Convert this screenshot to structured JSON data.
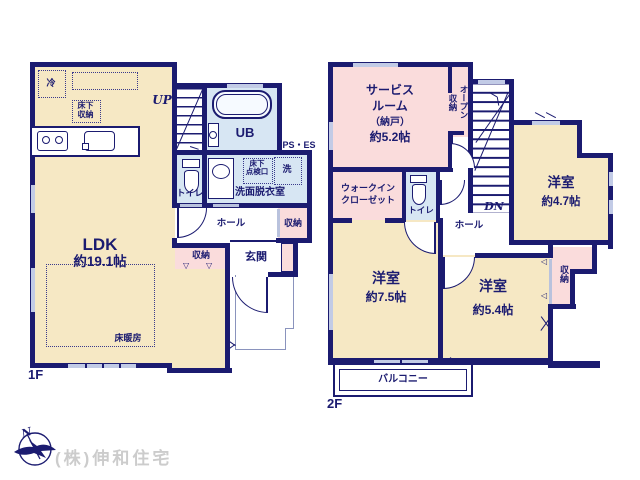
{
  "colors": {
    "wall": "#1b1b70",
    "beige": "#f6e8c4",
    "pink": "#fadcdc",
    "blue": "#d7e6f3",
    "window": "#c2cbe6",
    "porch": "#8a93bd",
    "watermark": "#cccccc",
    "fixture_fill": "#f6faff"
  },
  "symbols": {
    "tri_down": "▽",
    "tri_left": "◁"
  },
  "compass": {
    "north": "N"
  },
  "watermark": "(株)伸和住宅",
  "f1": {
    "floor": "1F",
    "ldk": {
      "name": "LDK",
      "size": "約19.1帖",
      "heating": "床暖房",
      "fridge": "冷",
      "uf1": "床下",
      "uf2": "収納",
      "closet": "収納"
    },
    "stairs": "UP",
    "bath": "UB",
    "shaft": "PS・ES",
    "toilet": "トイレ",
    "wash": {
      "name": "洗面脱衣室",
      "h1": "床下",
      "h2": "点検口",
      "washer": "洗"
    },
    "hall": {
      "name": "ホール",
      "closet": "収納"
    },
    "entrance": "玄関"
  },
  "f2": {
    "floor": "2F",
    "service": {
      "l1": "サービス",
      "l2": "ルーム",
      "l3": "（納戸）",
      "size": "約5.2帖",
      "open": "オープン収納"
    },
    "stairs": "DN",
    "r47": {
      "name": "洋室",
      "size": "約4.7帖"
    },
    "wic": {
      "l1": "ウォークイン",
      "l2": "クローゼット"
    },
    "toilet": "トイレ",
    "hall": "ホール",
    "r75": {
      "name": "洋室",
      "size": "約7.5帖"
    },
    "r54": {
      "name": "洋室",
      "size": "約5.4帖"
    },
    "closet": "収納",
    "balcony": "バルコニー"
  }
}
